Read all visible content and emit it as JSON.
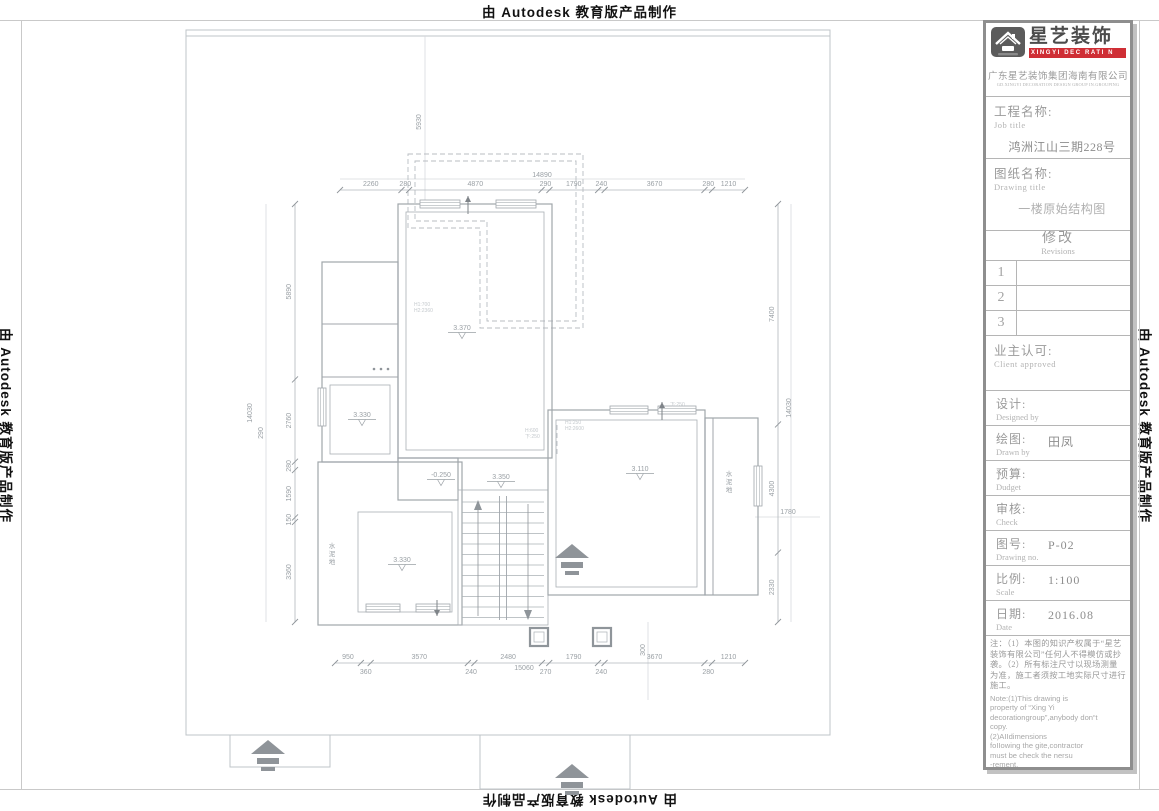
{
  "edge_watermarks": {
    "top": "由 Autodesk 教育版产品制作",
    "bottom": "由 Autodesk 教育版产品制作",
    "left": "由 Autodesk 教育版产品制作",
    "right": "由 Autodesk 教育版产品制作"
  },
  "title_block": {
    "brand": {
      "name_cn": "星艺装饰",
      "tagline": "XINGYI DEC RATI N",
      "company_cn": "广东星艺装饰集团海南有限公司",
      "company_en": "GD.XINGYI DECORATION DESIGN GROUP IN.GROUPING",
      "accent_red": "#cf2e35"
    },
    "job": {
      "label_cn": "工程名称:",
      "label_en": "Job title",
      "value": "鸿洲江山三期228号"
    },
    "sheet": {
      "label_cn": "图纸名称:",
      "label_en": "Drawing title",
      "value": "一楼原始结构图"
    },
    "revisions": {
      "label_cn": "修改",
      "label_en": "Revisions",
      "rows": [
        "1",
        "2",
        "3"
      ]
    },
    "client": {
      "label_cn": "业主认可:",
      "label_en": "Client approved",
      "value": ""
    },
    "designer": {
      "label_cn": "设计:",
      "label_en": "Designed by",
      "value": ""
    },
    "drafter": {
      "label_cn": "绘图:",
      "label_en": "Drawn by",
      "value": "田凤"
    },
    "budget": {
      "label_cn": "预算:",
      "label_en": "Dudget",
      "value": ""
    },
    "checker": {
      "label_cn": "审核:",
      "label_en": "Check",
      "value": ""
    },
    "drawing_no": {
      "label_cn": "图号:",
      "label_en": "Drawing no.",
      "value": "P-02"
    },
    "scale": {
      "label_cn": "比例:",
      "label_en": "Scale",
      "value": "1:100"
    },
    "date": {
      "label_cn": "日期:",
      "label_en": "Date",
      "value": "2016.08"
    },
    "notes_cn": "注：（1）本图的知识产权属于“星艺装饰有限公司”任何人不得模仿或抄袭。（2）所有标注尺寸以现场测量为准，施工者须按工地实际尺寸进行施工。",
    "notes_en": "Note:(1)This drawing is\nproperty of “Xing Yi\ndecorationgroup”,anybody don“t\ncopy.\n      (2)AIIdimensions\nfoIIowing the gite,contractor\nmust be check the nersu\n-rement."
  },
  "plan": {
    "dim_chains": [
      {
        "id": "top",
        "orient": "h",
        "line": 190,
        "start": 340,
        "end": 745,
        "values": [
          2260,
          280,
          4870,
          290,
          1790,
          240,
          3670,
          280,
          1210
        ],
        "alternate": false
      },
      {
        "id": "bottom",
        "orient": "h",
        "line": 663,
        "start": 335,
        "end": 745,
        "values": [
          950,
          360,
          3570,
          240,
          2480,
          270,
          1790,
          240,
          3670,
          280,
          1210
        ],
        "alternate": true
      },
      {
        "id": "left",
        "orient": "v",
        "line": 295,
        "start": 204,
        "end": 622,
        "values": [
          5890,
          2760,
          280,
          1590,
          150,
          3360
        ],
        "alternate": false
      },
      {
        "id": "right",
        "orient": "v",
        "line": 778,
        "start": 204,
        "end": 622,
        "values": [
          7400,
          4300,
          2330
        ],
        "alternate": false
      }
    ],
    "overall_dims": [
      {
        "text": "14890",
        "x": 542,
        "y": 177,
        "rot": false
      },
      {
        "text": "15060",
        "x": 524,
        "y": 670,
        "rot": false
      },
      {
        "text": "14030",
        "x": 252,
        "y": 413,
        "rot": true
      },
      {
        "text": "14030",
        "x": 791,
        "y": 408,
        "rot": true
      },
      {
        "text": "5930",
        "x": 421,
        "y": 122,
        "rot": true
      },
      {
        "text": "300",
        "x": 645,
        "y": 650,
        "rot": true
      },
      {
        "text": "1780",
        "x": 788,
        "y": 514,
        "rot": false
      },
      {
        "text": "290",
        "x": 263,
        "y": 433,
        "rot": true
      }
    ],
    "levels": [
      {
        "text": "3.370",
        "x": 462,
        "y": 330
      },
      {
        "text": "3.330",
        "x": 362,
        "y": 417
      },
      {
        "text": "3.330",
        "x": 402,
        "y": 562
      },
      {
        "text": "3.350",
        "x": 501,
        "y": 479
      },
      {
        "text": "3.110",
        "x": 640,
        "y": 471
      },
      {
        "text": "-0.250",
        "x": 441,
        "y": 477
      }
    ],
    "room_texts": [
      {
        "text": "水泥地",
        "x": 332,
        "y": 548
      },
      {
        "text": "水泥地",
        "x": 729,
        "y": 476
      }
    ],
    "micro_notes": [
      {
        "lines": [
          "H1:700",
          "H2:2360"
        ],
        "x": 414,
        "y": 306
      },
      {
        "lines": [
          "H:600",
          "下:250"
        ],
        "x": 525,
        "y": 432
      },
      {
        "lines": [
          "H1:250",
          "H2:2600"
        ],
        "x": 565,
        "y": 424
      },
      {
        "lines": [
          "下:250"
        ],
        "x": 670,
        "y": 406
      }
    ]
  }
}
